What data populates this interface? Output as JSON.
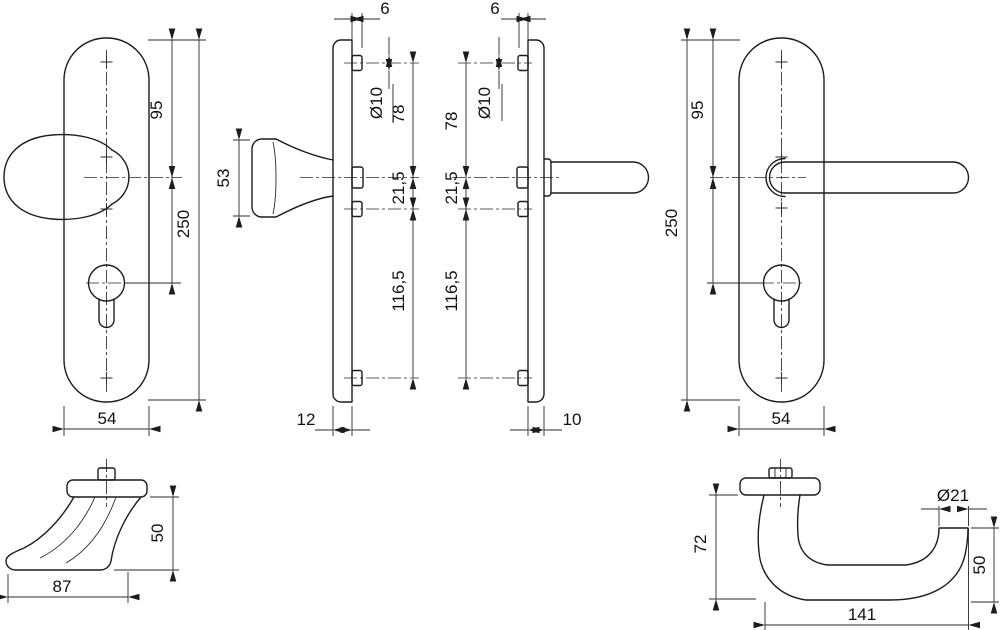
{
  "drawing": {
    "knob_plate_front": {
      "dim_95": "95",
      "dim_250": "250",
      "dim_54": "54"
    },
    "knob_plate_side": {
      "dim_6": "6",
      "dim_dia10": "Ø10",
      "dim_78": "78",
      "dim_21_5": "21,5",
      "dim_116_5": "116,5",
      "dim_12": "12",
      "dim_53": "53"
    },
    "lever_plate_side": {
      "dim_6": "6",
      "dim_dia10": "Ø10",
      "dim_78": "78",
      "dim_21_5": "21,5",
      "dim_116_5": "116,5",
      "dim_10": "10"
    },
    "lever_plate_front": {
      "dim_95": "95",
      "dim_250": "250",
      "dim_54": "54"
    },
    "knob_profile": {
      "dim_87": "87",
      "dim_50": "50"
    },
    "lever_profile": {
      "dim_72": "72",
      "dim_dia21": "Ø21",
      "dim_50": "50",
      "dim_141": "141"
    }
  },
  "colors": {
    "line": "#1c1c1c",
    "background": "#ffffff"
  }
}
